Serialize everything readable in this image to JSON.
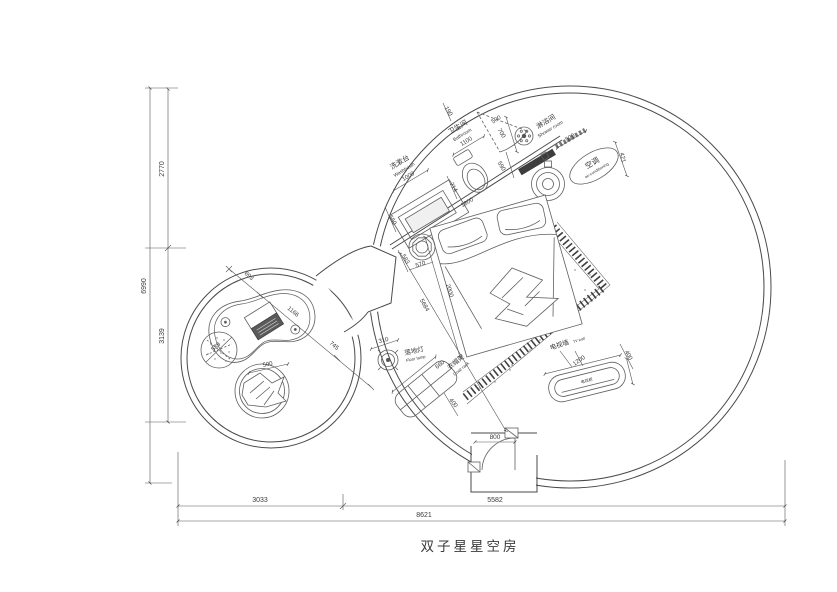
{
  "title": "双子星星空房",
  "labels": {
    "washbasin_cn": "洗漱台",
    "washbasin_en": "Washbasin",
    "bathroom_cn": "卫生间",
    "bathroom_en": "Bathroom",
    "shower_cn": "淋浴间",
    "shower_en": "Shower room",
    "ac_cn": "空调",
    "ac_en": "air-conditioning",
    "floor_lamp_cn": "落地灯",
    "floor_lamp_en": "Floor lamp",
    "coat_rack_cn": "衣帽架",
    "coat_rack_en": "Coat rack",
    "tv_wall_cn": "电视墙",
    "tv_wall_en": "TV wall",
    "tv_cabinet_cn": "电视柜"
  },
  "dims": {
    "overall_height": "6990",
    "height_top": "2770",
    "height_mid": "3139",
    "width_left": "3033",
    "width_right": "5582",
    "overall_width": "8621",
    "washbasin_width": "1000",
    "washbasin_depth": "550",
    "bathroom_width": "1100",
    "bathroom_gap": "190",
    "bathroom_depth": "700",
    "bath_door_swing": "500",
    "shower_offset": "590",
    "toilet_offset": "714",
    "bed_width": "1800",
    "bed_length": "2000",
    "stool_width": "583",
    "stool_depth": "570",
    "shower_width": "520",
    "ac_offset": "421",
    "room_diagonal": "5684",
    "lamp_diameter": "310",
    "coat_rack_length": "660",
    "coat_rack_depth": "400",
    "tv_length": "1200",
    "tv_depth": "400",
    "entry_door_width": "800",
    "table_gap": "693",
    "table_length": "1166",
    "passage_width": "745",
    "rug_diameter": "589",
    "chair_diameter": "500"
  }
}
